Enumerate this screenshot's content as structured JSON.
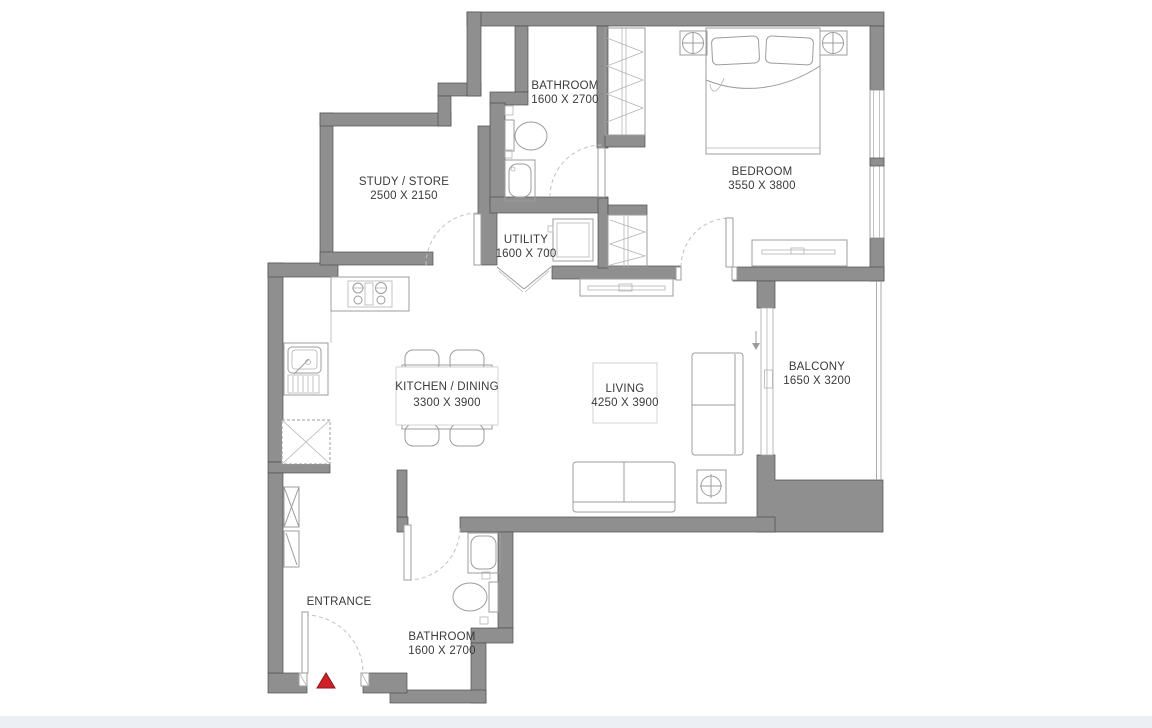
{
  "rooms": {
    "bathroom_top": {
      "name": "BATHROOM",
      "dims": "1600 X 2700"
    },
    "study": {
      "name": "STUDY / STORE",
      "dims": "2500 X 2150"
    },
    "utility": {
      "name": "UTILITY",
      "dims": "1600 X 700"
    },
    "bedroom": {
      "name": "BEDROOM",
      "dims": "3550 X 3800"
    },
    "kitchen_dining": {
      "name": "KITCHEN / DINING",
      "dims": "3300 X 3900"
    },
    "living": {
      "name": "LIVING",
      "dims": "4250 X 3900"
    },
    "balcony": {
      "name": "BALCONY",
      "dims": "1650 X 3200"
    },
    "bathroom_bottom": {
      "name": "BATHROOM",
      "dims": "1600 X 2700"
    },
    "entrance": {
      "name": "ENTRANCE"
    }
  },
  "colors": {
    "background": "#ffffff",
    "wall": "#8f8f8f",
    "wall_edge": "#4f4f4f",
    "furniture_line": "#9c9c9c",
    "door_arc": "#c2c2c2",
    "text": "#3a3a3a",
    "entrance_marker": "#d02027",
    "footer_strip": "#eceff4"
  },
  "icons": {
    "entrance_marker": "red-triangle-entry-marker",
    "balcony_door_arrow": "down-arrow"
  }
}
